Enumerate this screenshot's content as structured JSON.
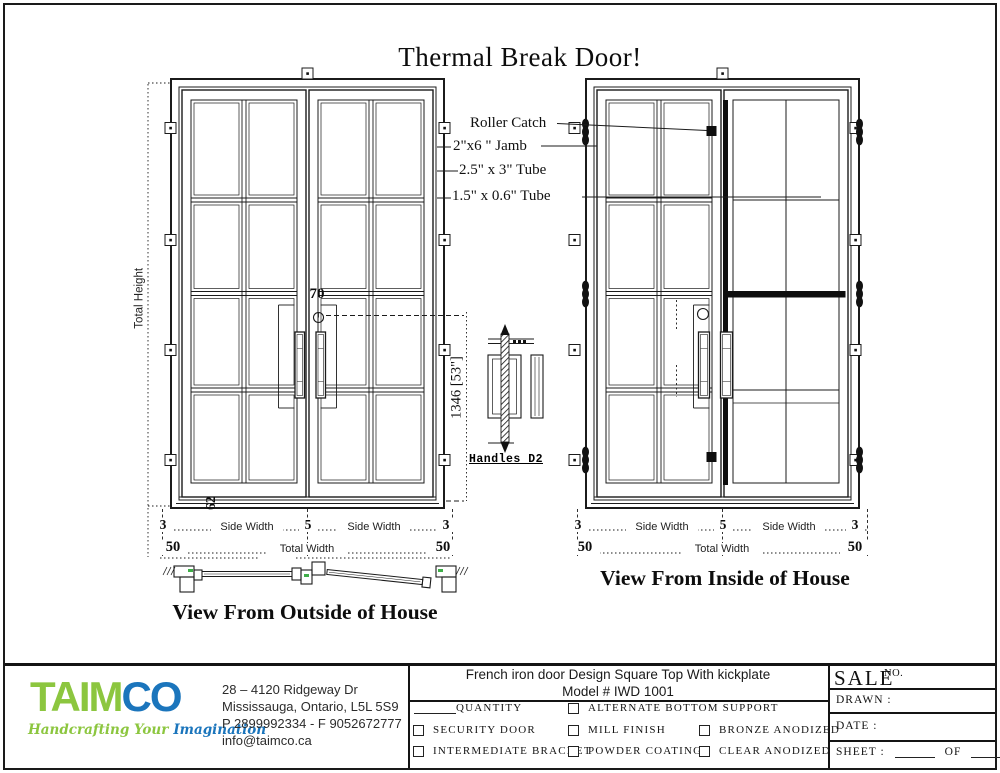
{
  "sheet": {
    "title": "Thermal Break Door!"
  },
  "callouts": {
    "roller_catch": "Roller Catch",
    "jamb": "2\"x6 \" Jamb",
    "tube_large": "2.5\" x 3\" Tube",
    "tube_small": "1.5\" x 0.6\" Tube"
  },
  "dimensions": {
    "total_height": "Total Height",
    "handle_spacing": "70",
    "kick_height": "62",
    "handle_height": "1346 [53\"]",
    "side_margin": "3",
    "center_gap": "5",
    "side_width": "Side Width",
    "total_width": "Total Width",
    "frame_ext": "50"
  },
  "views": {
    "outside_caption": "View From Outside of House",
    "inside_caption": "View From Inside of House",
    "handle_detail_label": "Handles D2"
  },
  "title_block": {
    "brand": {
      "name_green": "TAIM",
      "name_blue": "CO",
      "tagline_green": "Handcrafting Your",
      "tagline_blue": "Imagination",
      "green": "#8cc63f",
      "blue": "#1b75bc",
      "hardware_green": "#3fae49"
    },
    "address": [
      "28 – 4120 Ridgeway Dr",
      "Mississauga, Ontario, L5L 5S9",
      "P 2899992334 - F 9052672777",
      "info@taimco.ca"
    ],
    "drawing_title": "French iron door Design Square Top With kickplate",
    "model": "Model # IWD 1001",
    "options": {
      "quantity": "QUANTITY",
      "alternate_bottom_support": "ALTERNATE BOTTOM SUPPORT",
      "security_door": "SECURITY DOOR",
      "mill_finish": "MILL FINISH",
      "bronze_anodized": "BRONZE ANODIZED",
      "intermediate_bracket": "INTERMEDIATE BRACKET",
      "powder_coating": "POWDER COATING",
      "clear_anodized": "CLEAR ANODIZED"
    },
    "sale": {
      "label": "SALE",
      "no": "NO.",
      "drawn": "DRAWN :",
      "date": "DATE :",
      "sheet": "SHEET :",
      "of": "OF"
    }
  }
}
